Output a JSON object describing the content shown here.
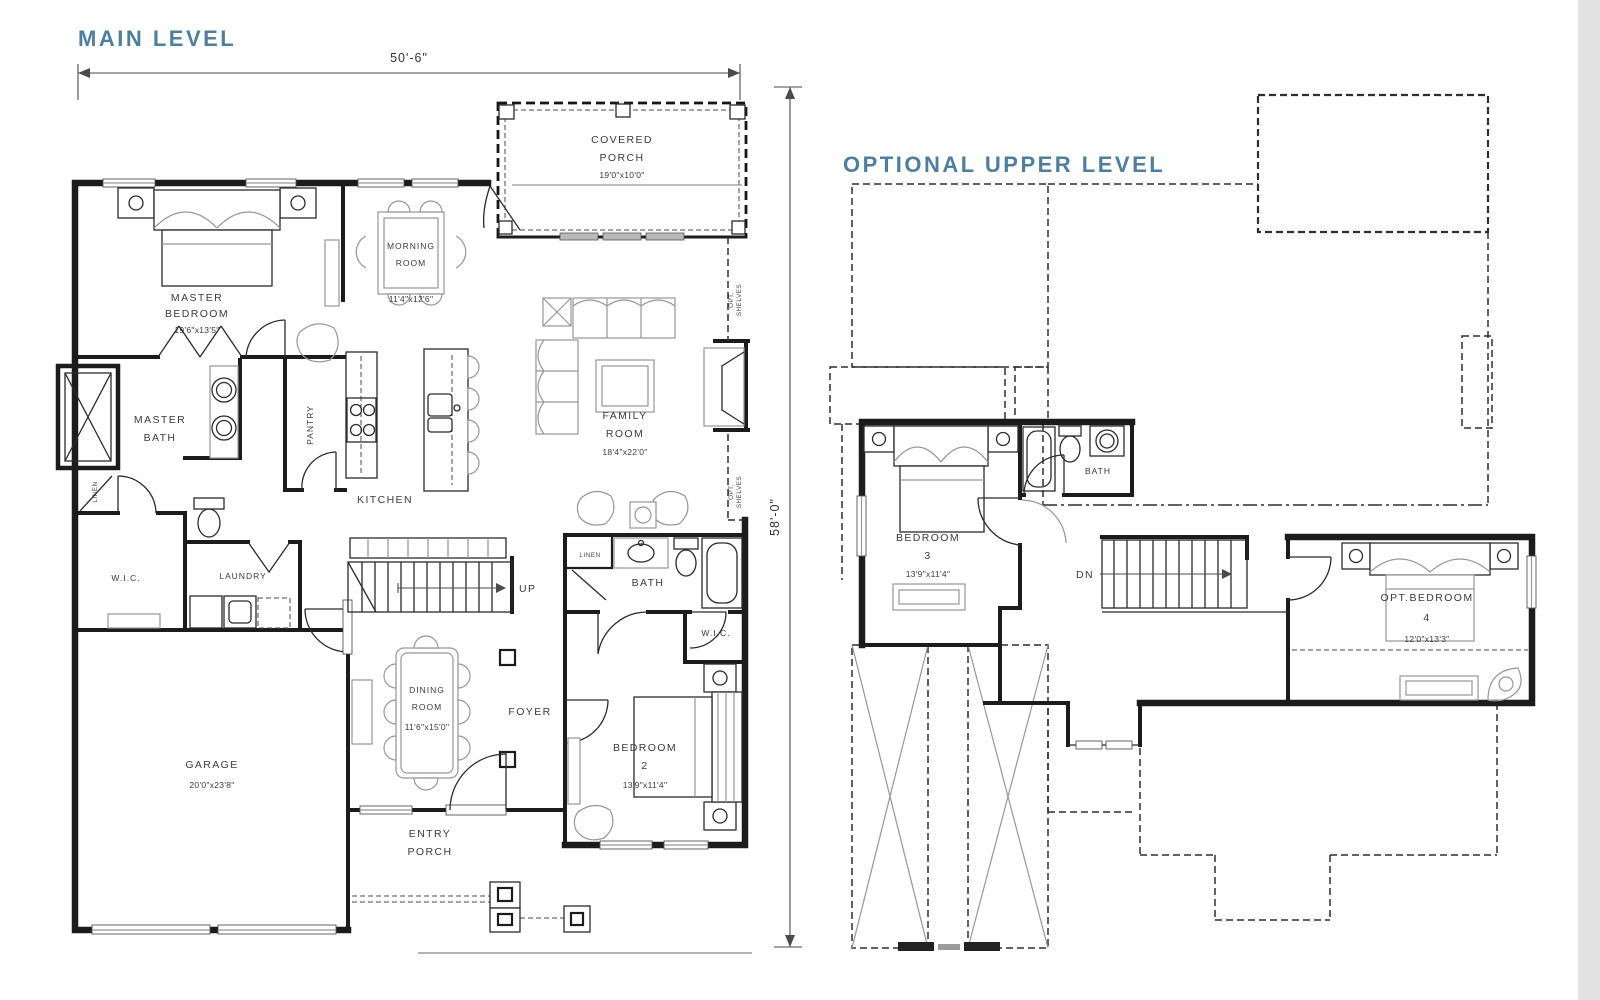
{
  "colors": {
    "accent": "#4e7f9f",
    "wall": "#1c1c1c",
    "furniture": "#979797",
    "text": "#3c3c3c"
  },
  "main": {
    "title": "MAIN LEVEL",
    "dim_width": "50'-6\"",
    "dim_height": "58'-0\"",
    "rooms": {
      "covered_porch": {
        "l1": "COVERED",
        "l2": "PORCH",
        "dims": "19'0\"x10'0\""
      },
      "master_bedroom": {
        "l1": "MASTER",
        "l2": "BEDROOM",
        "dims": "19'6\"x13'5\""
      },
      "morning_room": {
        "l1": "MORNING",
        "l2": "ROOM",
        "dims": "11'4\"x12'6\""
      },
      "family_room": {
        "l1": "FAMILY",
        "l2": "ROOM",
        "dims": "18'4\"x22'0\""
      },
      "master_bath": {
        "l1": "MASTER",
        "l2": "BATH"
      },
      "pantry": {
        "l1": "PANTRY"
      },
      "kitchen": {
        "l1": "KITCHEN"
      },
      "wic_master": {
        "l1": "W.I.C."
      },
      "laundry": {
        "l1": "LAUNDRY"
      },
      "linen_master": {
        "l1": "LINEN"
      },
      "stairs": {
        "l1": "UP"
      },
      "bath": {
        "l1": "BATH"
      },
      "linen_bath": {
        "l1": "LINEN"
      },
      "wic_bedroom2": {
        "l1": "W.I.C."
      },
      "dining_room": {
        "l1": "DINING",
        "l2": "ROOM",
        "dims": "11'6\"x15'0\""
      },
      "foyer": {
        "l1": "FOYER"
      },
      "bedroom_2": {
        "l1": "BEDROOM",
        "l2": "2",
        "dims": "13'9\"x11'4\""
      },
      "garage": {
        "l1": "GARAGE",
        "dims": "20'0\"x23'8\""
      },
      "entry_porch": {
        "l1": "ENTRY",
        "l2": "PORCH"
      },
      "opt_shelves_upper": {
        "l1": "OPT.",
        "l2": "SHELVES"
      },
      "opt_shelves_lower": {
        "l1": "OPT.",
        "l2": "SHELVES"
      }
    }
  },
  "upper": {
    "title": "OPTIONAL UPPER LEVEL",
    "rooms": {
      "bedroom_3": {
        "l1": "BEDROOM",
        "l2": "3",
        "dims": "13'9\"x11'4\""
      },
      "bath": {
        "l1": "BATH"
      },
      "stairs": {
        "l1": "DN"
      },
      "opt_bedroom_4": {
        "l1": "OPT.BEDROOM",
        "l2": "4",
        "dims": "12'0\"x13'3\""
      }
    }
  }
}
